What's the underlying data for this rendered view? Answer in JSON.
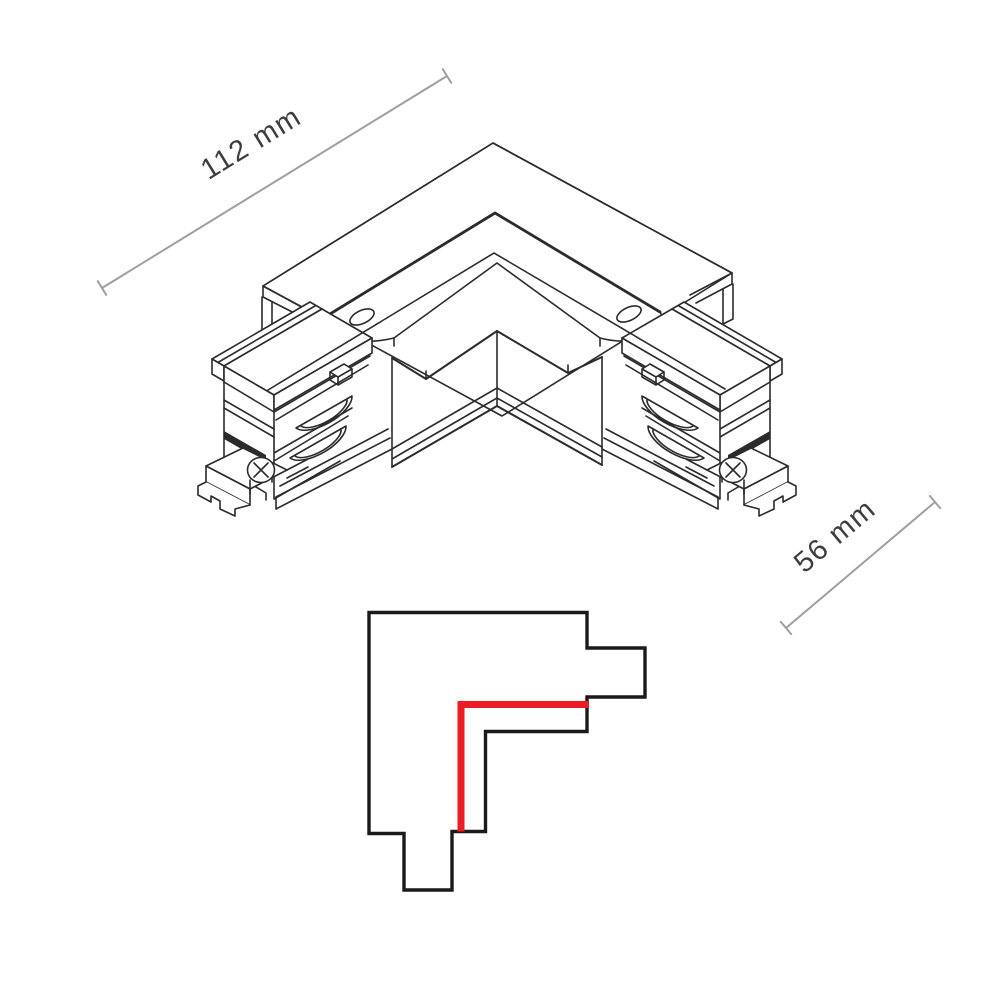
{
  "dimensions": {
    "width_label": "112 mm",
    "depth_label": "56 mm"
  },
  "colors": {
    "line": "#2b2b2b",
    "red_isometric": "#d5565a",
    "red_schematic": "#ec1c24",
    "dimension_gray": "#9f9f9f",
    "label_text": "#3d3d3d",
    "background": "#ffffff"
  }
}
